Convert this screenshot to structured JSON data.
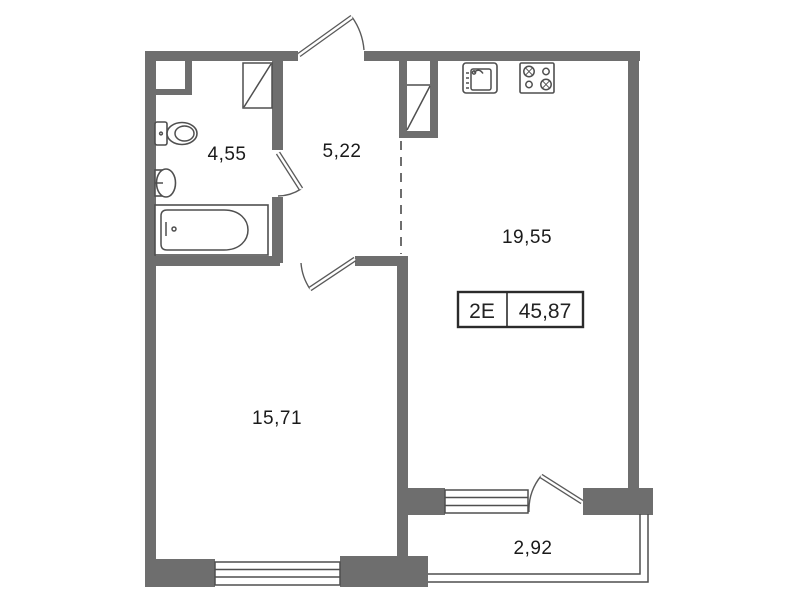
{
  "plan": {
    "rooms": {
      "bathroom": {
        "area": "4,55"
      },
      "hallway": {
        "area": "5,22"
      },
      "kitchen_living": {
        "area": "19,55"
      },
      "living_room": {
        "area": "15,71"
      },
      "balcony": {
        "area": "2,92"
      }
    },
    "unit_badge": {
      "type_label": "2Е",
      "total_area": "45,87"
    },
    "icons": {
      "toilet": "toilet-icon",
      "washbasin": "washbasin-icon",
      "bathtub": "bathtub-icon",
      "shower_cabinet": "shower-cabinet-icon",
      "wardrobe": "wardrobe-icon",
      "kitchen_sink": "kitchen-sink-icon",
      "stove": "stove-burners-icon",
      "ventilation_duct": "ventilation-duct-icon"
    },
    "colors": {
      "wall": "#6e6e6e",
      "line": "#4f4f4f",
      "text": "#1a1a1a",
      "badge_border": "#2b2b2b",
      "background": "#ffffff"
    }
  }
}
